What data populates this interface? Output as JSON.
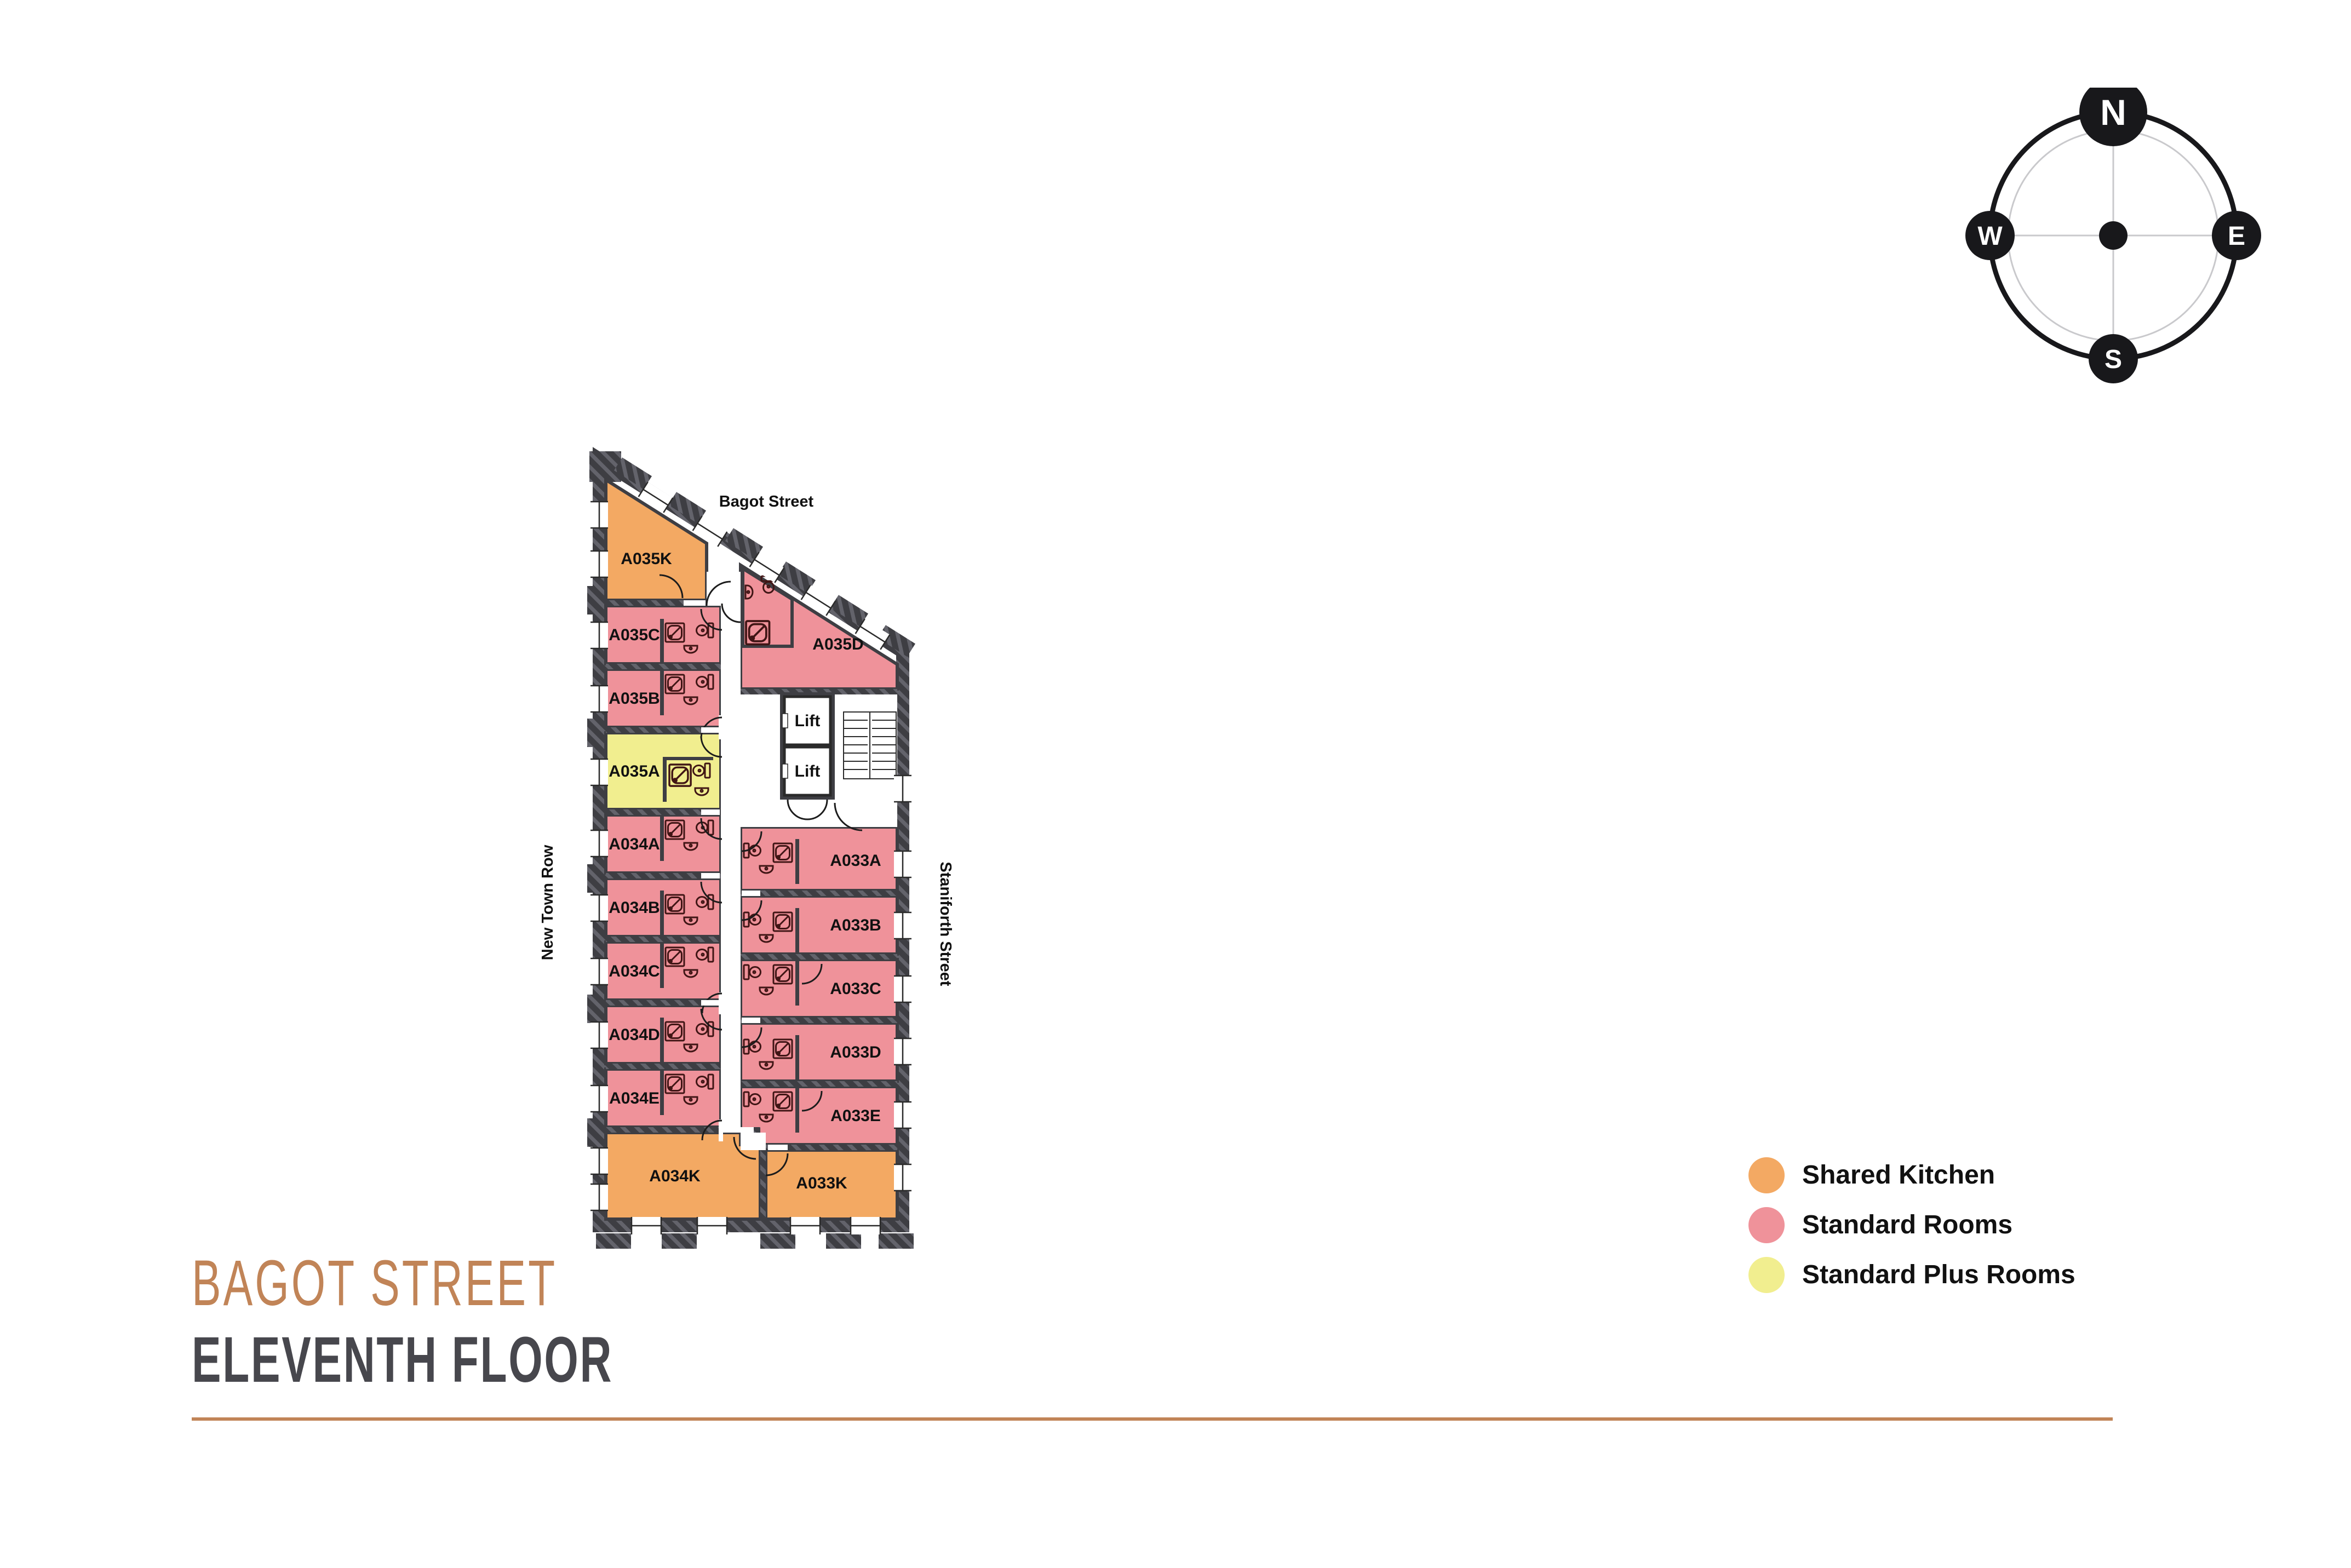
{
  "colors": {
    "shared_kitchen": "#F3A963",
    "standard": "#EF929A",
    "standard_plus": "#F1EE8F",
    "wall": "#3E3E43",
    "wall_stripe": "#63636B",
    "accent": "#C18457",
    "ink": "#111111",
    "fixture": "#401515"
  },
  "title": {
    "line1": "BAGOT STREET",
    "line2": "ELEVENTH FLOOR"
  },
  "legend": {
    "items": [
      {
        "label": "Shared Kitchen",
        "key": "shared_kitchen"
      },
      {
        "label": "Standard Rooms",
        "key": "standard"
      },
      {
        "label": "Standard Plus Rooms",
        "key": "standard_plus"
      }
    ]
  },
  "compass": {
    "north": "N",
    "south": "S",
    "east": "E",
    "west": "W"
  },
  "streets": {
    "top": "Bagot Street",
    "left": "New Town Row",
    "right": "Staniforth Street"
  },
  "plan": {
    "lift_label": "Lift",
    "rooms": [
      {
        "label": "A035K",
        "type": "shared_kitchen"
      },
      {
        "label": "A035C",
        "type": "standard"
      },
      {
        "label": "A035B",
        "type": "standard"
      },
      {
        "label": "A035A",
        "type": "standard_plus"
      },
      {
        "label": "A034A",
        "type": "standard"
      },
      {
        "label": "A034B",
        "type": "standard"
      },
      {
        "label": "A034C",
        "type": "standard"
      },
      {
        "label": "A034D",
        "type": "standard"
      },
      {
        "label": "A034E",
        "type": "standard"
      },
      {
        "label": "A034K",
        "type": "shared_kitchen"
      },
      {
        "label": "A035D",
        "type": "standard"
      },
      {
        "label": "A033A",
        "type": "standard"
      },
      {
        "label": "A033B",
        "type": "standard"
      },
      {
        "label": "A033C",
        "type": "standard"
      },
      {
        "label": "A033D",
        "type": "standard"
      },
      {
        "label": "A033E",
        "type": "standard"
      },
      {
        "label": "A033K",
        "type": "shared_kitchen"
      }
    ]
  }
}
